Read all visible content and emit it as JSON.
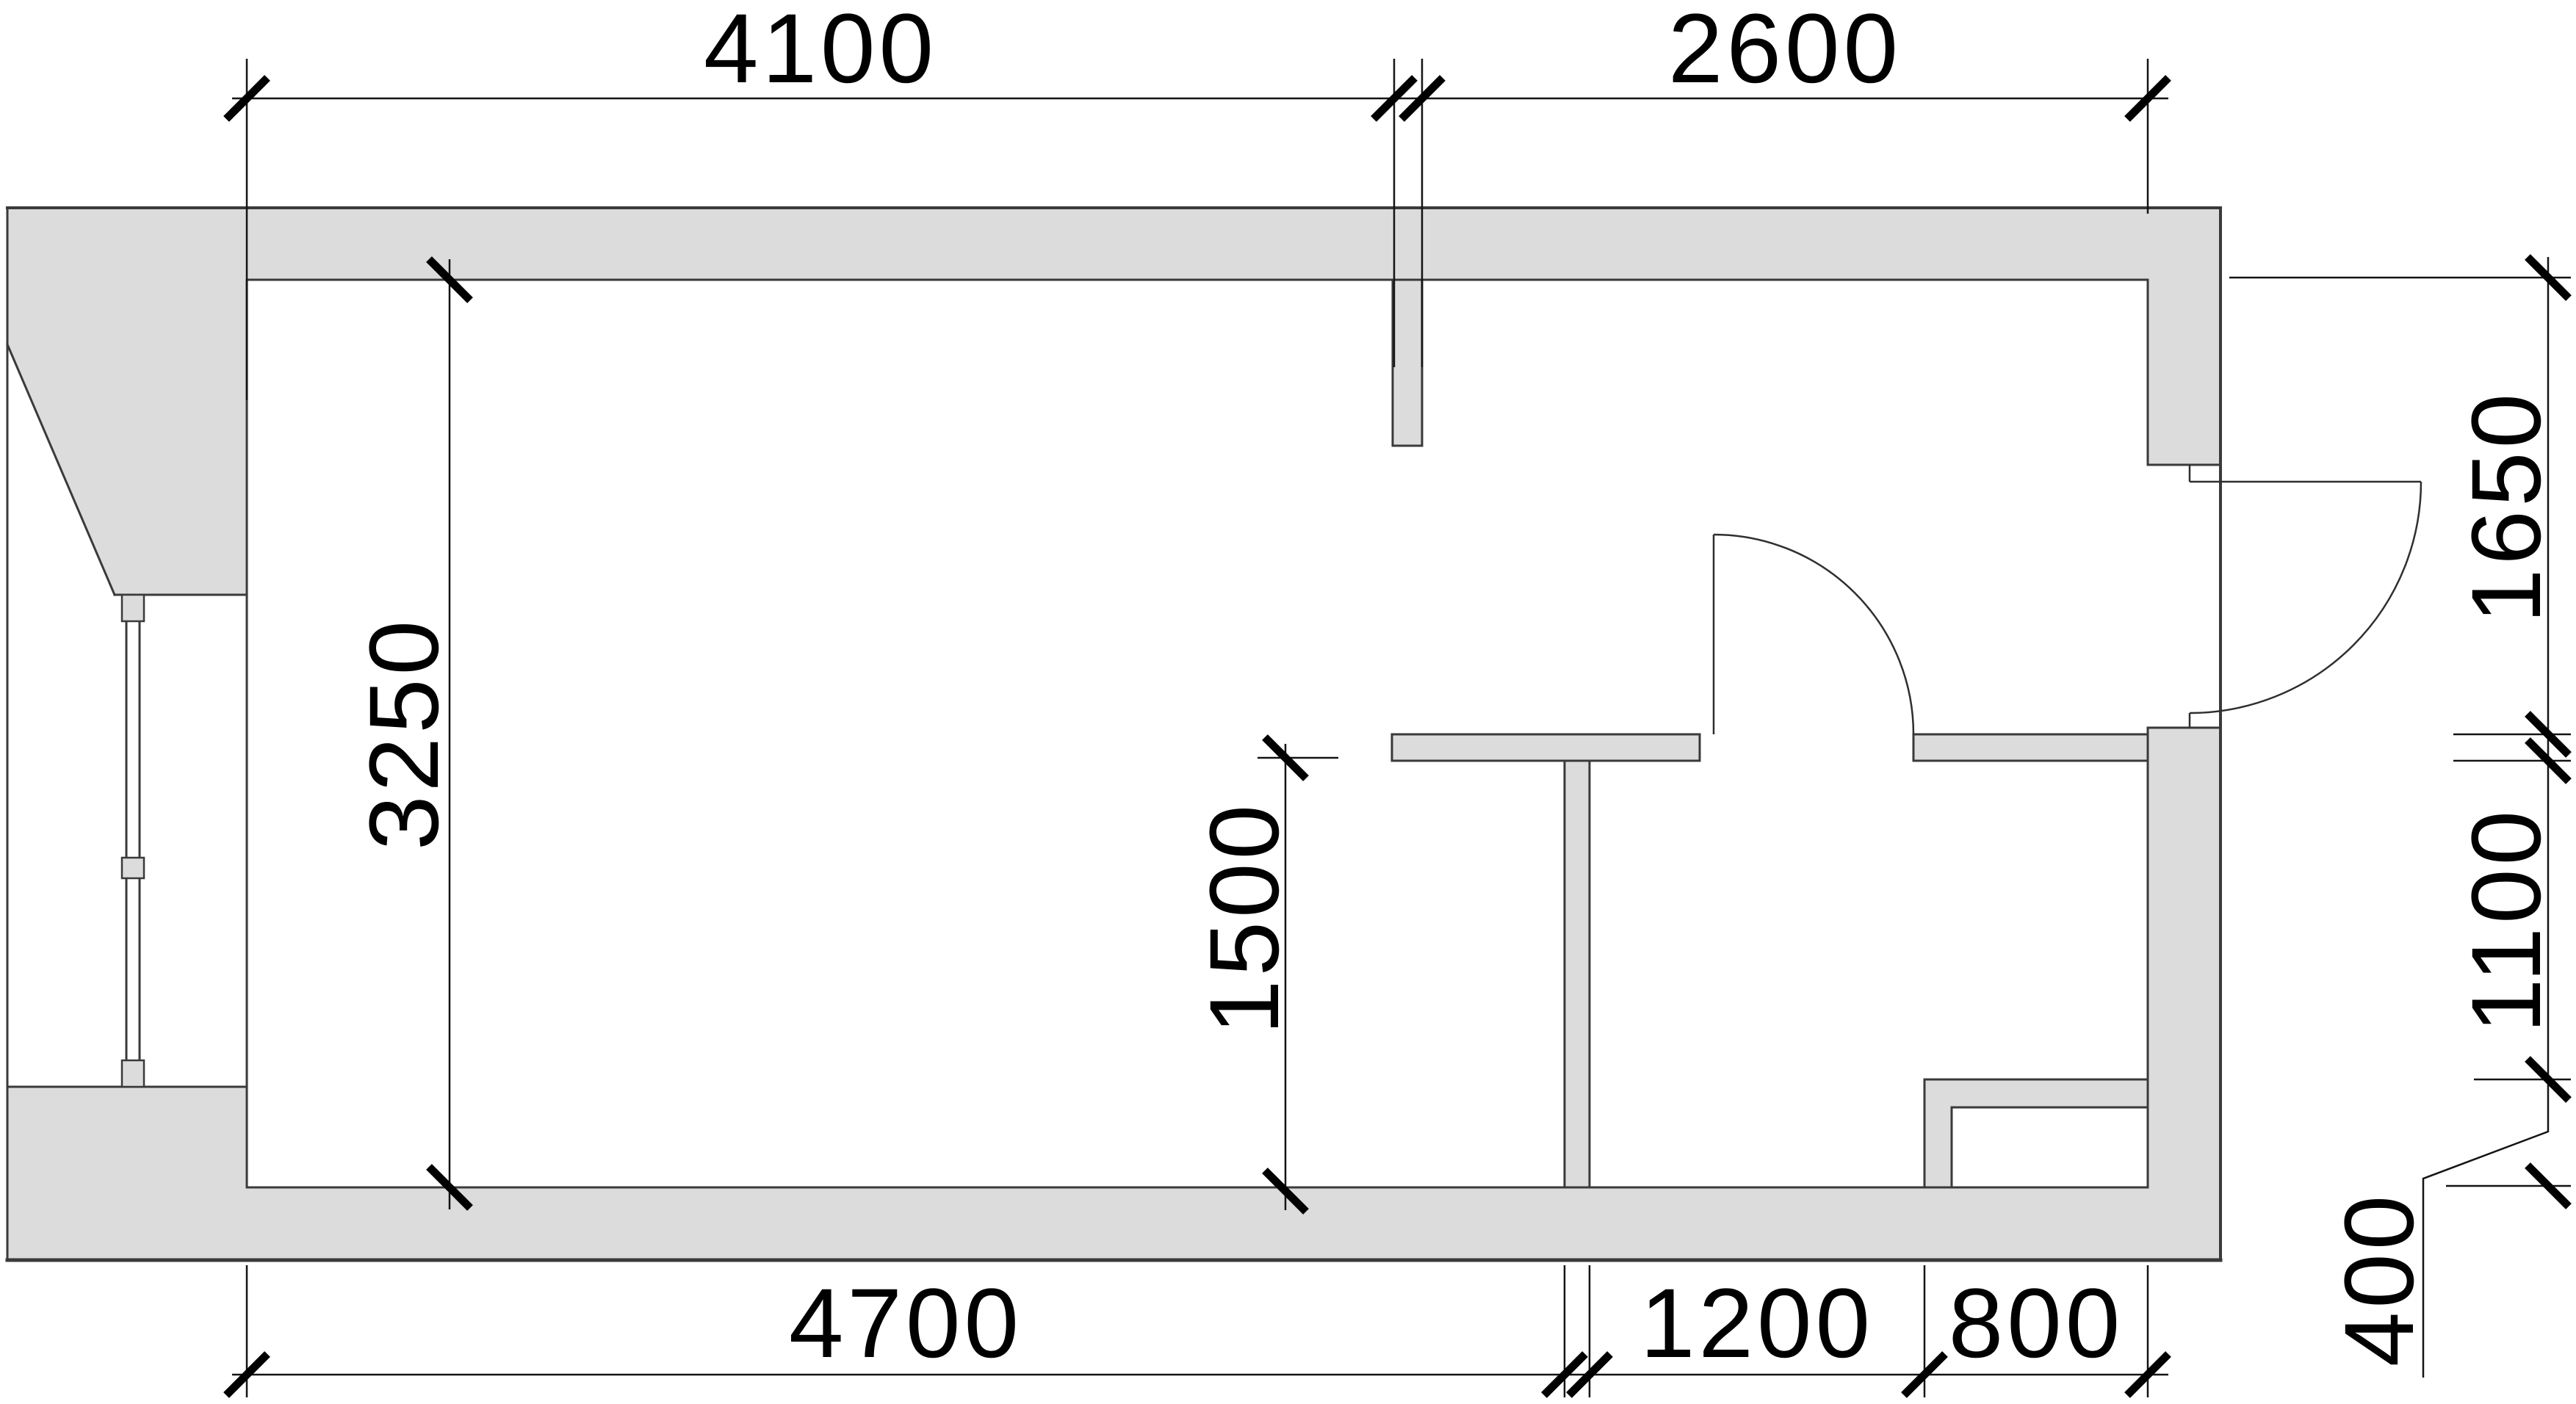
{
  "drawing": {
    "kind": "architectural floor plan",
    "units": "mm"
  },
  "colors": {
    "wall_fill": "#dcdcdc",
    "wall_line": "#3a3a3a",
    "dim_line": "#141414",
    "door_line": "#2f2f2f",
    "text": "#000000"
  },
  "dimensions": {
    "top": {
      "seg1": {
        "label": "4100"
      },
      "seg2": {
        "label": "2600"
      }
    },
    "bottom": {
      "seg1": {
        "label": "4700"
      },
      "seg2": {
        "label": "1200"
      },
      "seg3": {
        "label": "800"
      }
    },
    "left": {
      "seg1": {
        "label": "3250"
      }
    },
    "interior": {
      "seg1": {
        "label": "1500"
      }
    },
    "right": {
      "seg1": {
        "label": "1650"
      },
      "seg2": {
        "label": "1100"
      },
      "seg3": {
        "label": "400"
      }
    }
  }
}
